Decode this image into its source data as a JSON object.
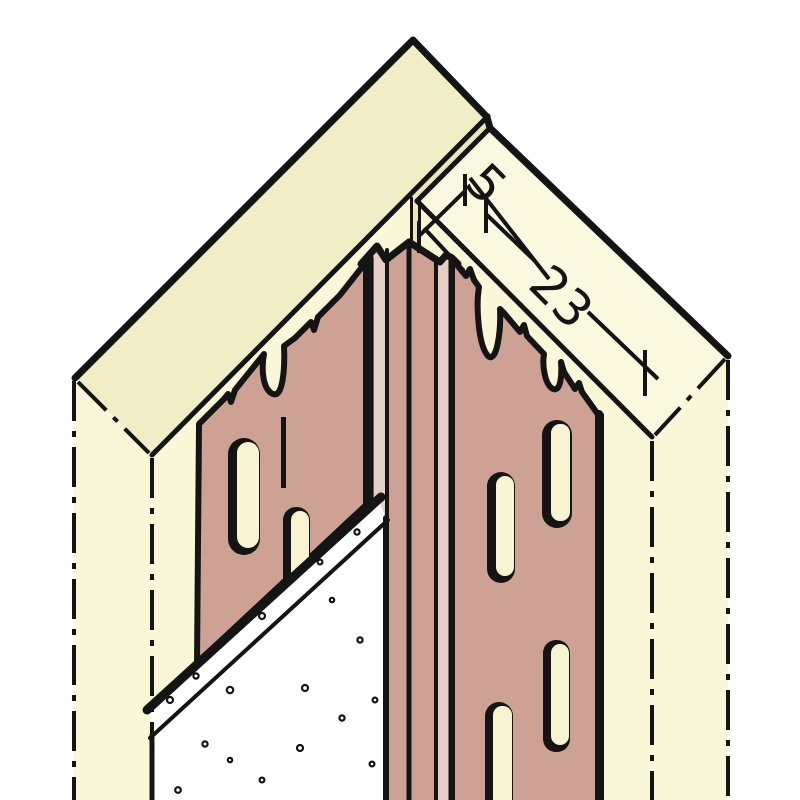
{
  "diagram": {
    "kind": "technical-illustration",
    "subject": "corner expansion-joint plaster profile on plasterboard wall corner",
    "dimensions": {
      "joint_width_label": "5",
      "flange_width_label": "23"
    },
    "colors": {
      "background": "#FFFFFF",
      "line": "#141414",
      "wall_front": "#FAF7D8",
      "wall_top_left": "#F1EDC7",
      "wall_top_right": "#FAF8DE",
      "joint_face": "#ECE6C0",
      "board_white": "#FFFFFF",
      "profile": "#CDA294",
      "profile_light": "#E4CEC5",
      "slot_fill": "#F8F4D2"
    }
  }
}
